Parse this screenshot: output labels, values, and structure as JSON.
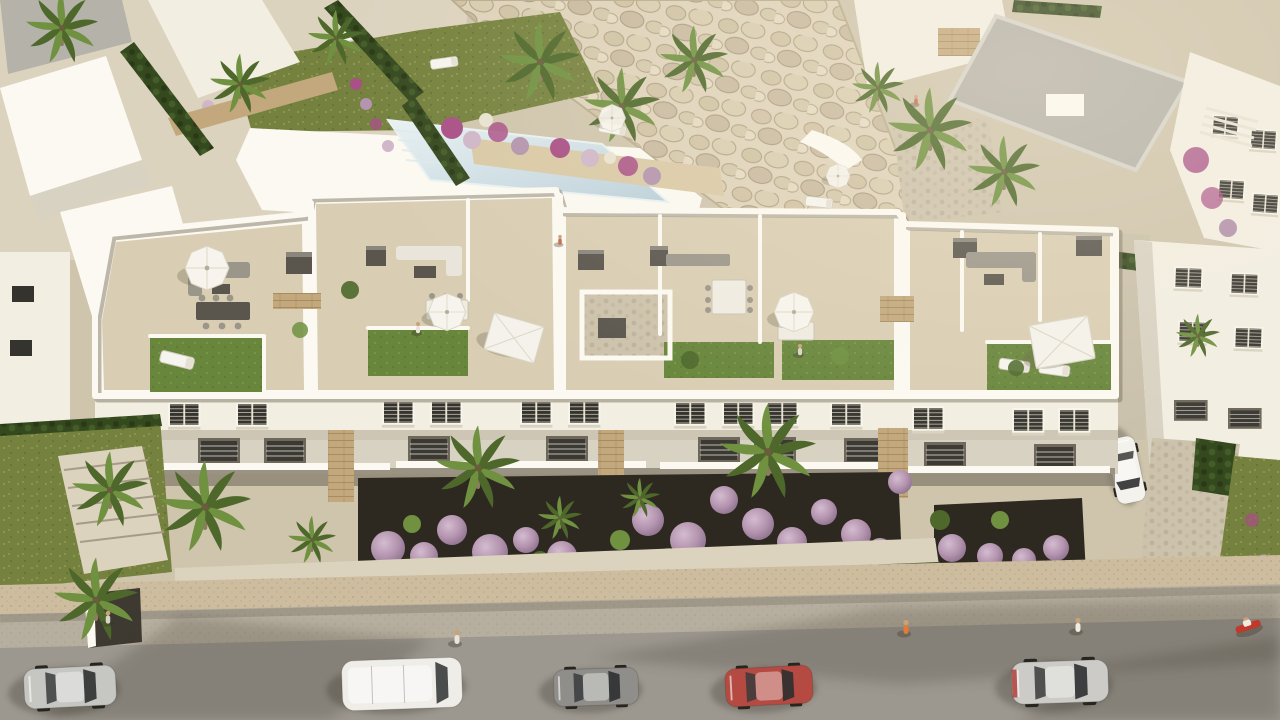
{
  "scene": {
    "type": "aerial 3d architectural rendering",
    "subject": "white Mediterranean apartment complex with landscaped rooftop terraces",
    "lighting": "warm late-afternoon sun from upper right, long soft shadows on street",
    "foreground": "grey asphalt street with parked cars and pedestrians",
    "midground": "three-storey white apartment block, front gardens with palms and lilac shrubs",
    "background": "white villas, swimming pool, natural rock retaining wall"
  },
  "palette": {
    "base": "#cfc5ad",
    "pavingLight": "#dcd3bf",
    "pavingCool": "#c9c0ab",
    "road": "#9c978f",
    "sidewalk": "#b6ae9e",
    "boundaryWall": "#cdbd9e",
    "wallWhite": "#f2eee2",
    "wallBright": "#fbf9f1",
    "wallShade": "#d8d2c3",
    "wallDark": "#bcb5a5",
    "stoneTan": "#c2a87c",
    "stoneLight": "#d9c9a6",
    "rockLight": "#ded3ba",
    "rockMid": "#cfc2a4",
    "rockShade": "#ab9d7f",
    "roofGrey": "#b5b2a9",
    "terraceFloor": "#d9cdb3",
    "grassRoof": "#68863c",
    "grassLawn": "#75813e",
    "grassLight": "#8a9b4a",
    "hedgeDark": "#35491f",
    "palmGreen": "#4d682a",
    "palmLight": "#6f9140",
    "trunk": "#8c7b5c",
    "soil": "#2d2921",
    "lilac": "#b393ae",
    "lilacLight": "#cfb6c9",
    "magenta": "#a84f86",
    "pool": "#cfdfe6",
    "poolEdge": "#e9f1f3",
    "windowDark": "#34332e",
    "furnGrey": "#9b968a",
    "furnDark": "#5a564e",
    "shadow": "#3a362c"
  },
  "objects": {
    "cars": [
      {
        "name": "silver-suv",
        "color": "#c6c6c2"
      },
      {
        "name": "white-van",
        "color": "#efede8"
      },
      {
        "name": "grey-hatchback",
        "color": "#8f8e8a"
      },
      {
        "name": "red-car",
        "color": "#b44a41"
      },
      {
        "name": "silver-sedan",
        "color": "#cccbc7"
      },
      {
        "name": "white-parked-car",
        "color": "#f4f2ec"
      }
    ],
    "moped": {
      "color": "#c0392b"
    },
    "pedestrians": 6,
    "pool": {
      "present": true,
      "color": "#cfdfe6"
    },
    "rooftop_terraces": {
      "count": 5,
      "features": [
        "artificial grass patches",
        "white parasols",
        "outdoor sofas",
        "dining tables",
        "sun loungers",
        "stair bulkheads"
      ]
    },
    "vegetation": [
      "palm trees",
      "lilac flowering shrubs",
      "dark hedges",
      "bougainvillea",
      "lawns"
    ]
  }
}
